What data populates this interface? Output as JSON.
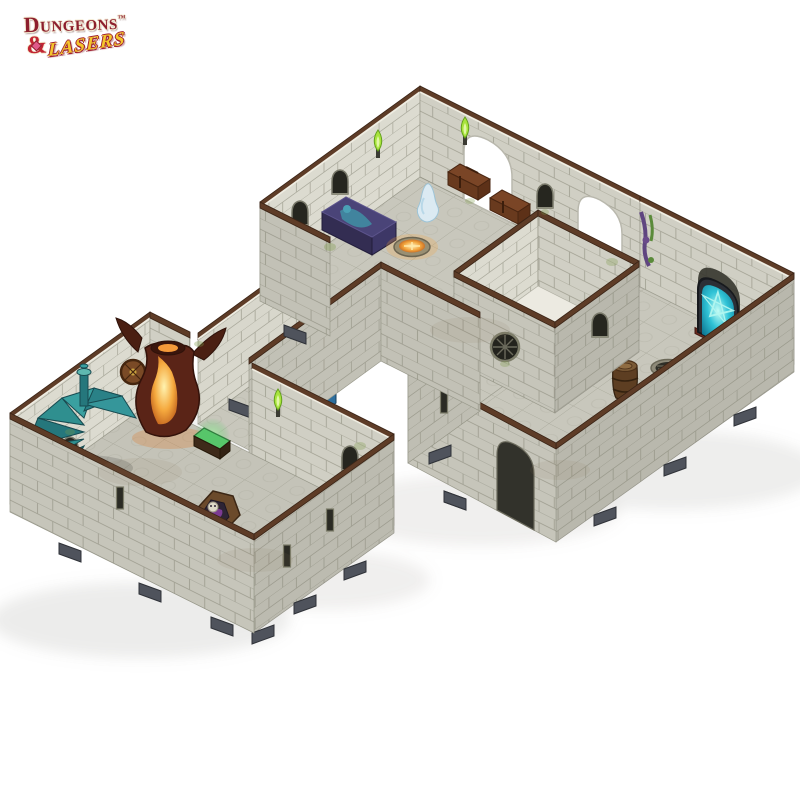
{
  "page": {
    "background": "#ffffff"
  },
  "logo": {
    "word1": "Dungeons",
    "trademark": "™",
    "ampersand": "&",
    "word2": "Lasers",
    "word1_color": "#8d1f2e",
    "word2_color": "#f3c52d"
  },
  "scene": {
    "subject": "modular-dungeon-terrain-set",
    "palette": {
      "wall_light": "#dcdbd0",
      "wall_mid": "#d0cfc4",
      "wall_exterior": "#c2c1b6",
      "mortar": "#85857a",
      "floor": "#c8c7bc",
      "inner_floor": "#eceae1",
      "trim_brown": "#5e3c27",
      "cut_edge_white": "#efede2",
      "clip_grey": "#4f535c",
      "stairs_teal": "#2f8f8f",
      "portal_cyan": "#2fc3d6",
      "fire_orange": "#f2a43c",
      "torch_green": "#a8e43c",
      "chest_brown": "#7a4526",
      "chest_blue": "#4694c9",
      "sarcophagus_purple": "#3d3766",
      "skeleton_bone": "#ddd8c8",
      "coffin_wood": "#6b4a2b",
      "mimic_teal": "#2fa9a2",
      "barrel_brown": "#5d3e22"
    },
    "props": [
      {
        "name": "spiral-staircase",
        "color": "#2f8f8f"
      },
      {
        "name": "fire-urn",
        "color": "#f2a43c"
      },
      {
        "name": "wall-shield",
        "color": "#7a4a26"
      },
      {
        "name": "glowing-green-chest",
        "color": "#57c66a"
      },
      {
        "name": "open-coffin-with-skeleton",
        "color": "#6b4a2b"
      },
      {
        "name": "mimic-orb",
        "color": "#2fa9a2"
      },
      {
        "name": "blue-chest",
        "color": "#4694c9"
      },
      {
        "name": "sarcophagus",
        "color": "#3d3766"
      },
      {
        "name": "ghost",
        "color": "#dcecf4"
      },
      {
        "name": "fire-pit",
        "color": "#f2a43c"
      },
      {
        "name": "treasure-chest-1",
        "color": "#7a4526"
      },
      {
        "name": "treasure-chest-2",
        "color": "#7a4526"
      },
      {
        "name": "arcane-portal-mirror",
        "color": "#2fc3d6"
      },
      {
        "name": "wall-vines",
        "color": "#6a4a8a"
      },
      {
        "name": "barrel",
        "color": "#5d3e22"
      },
      {
        "name": "sewer-grate",
        "color": "#2e2e27"
      },
      {
        "name": "green-wall-torch",
        "color": "#a8e43c"
      }
    ]
  }
}
